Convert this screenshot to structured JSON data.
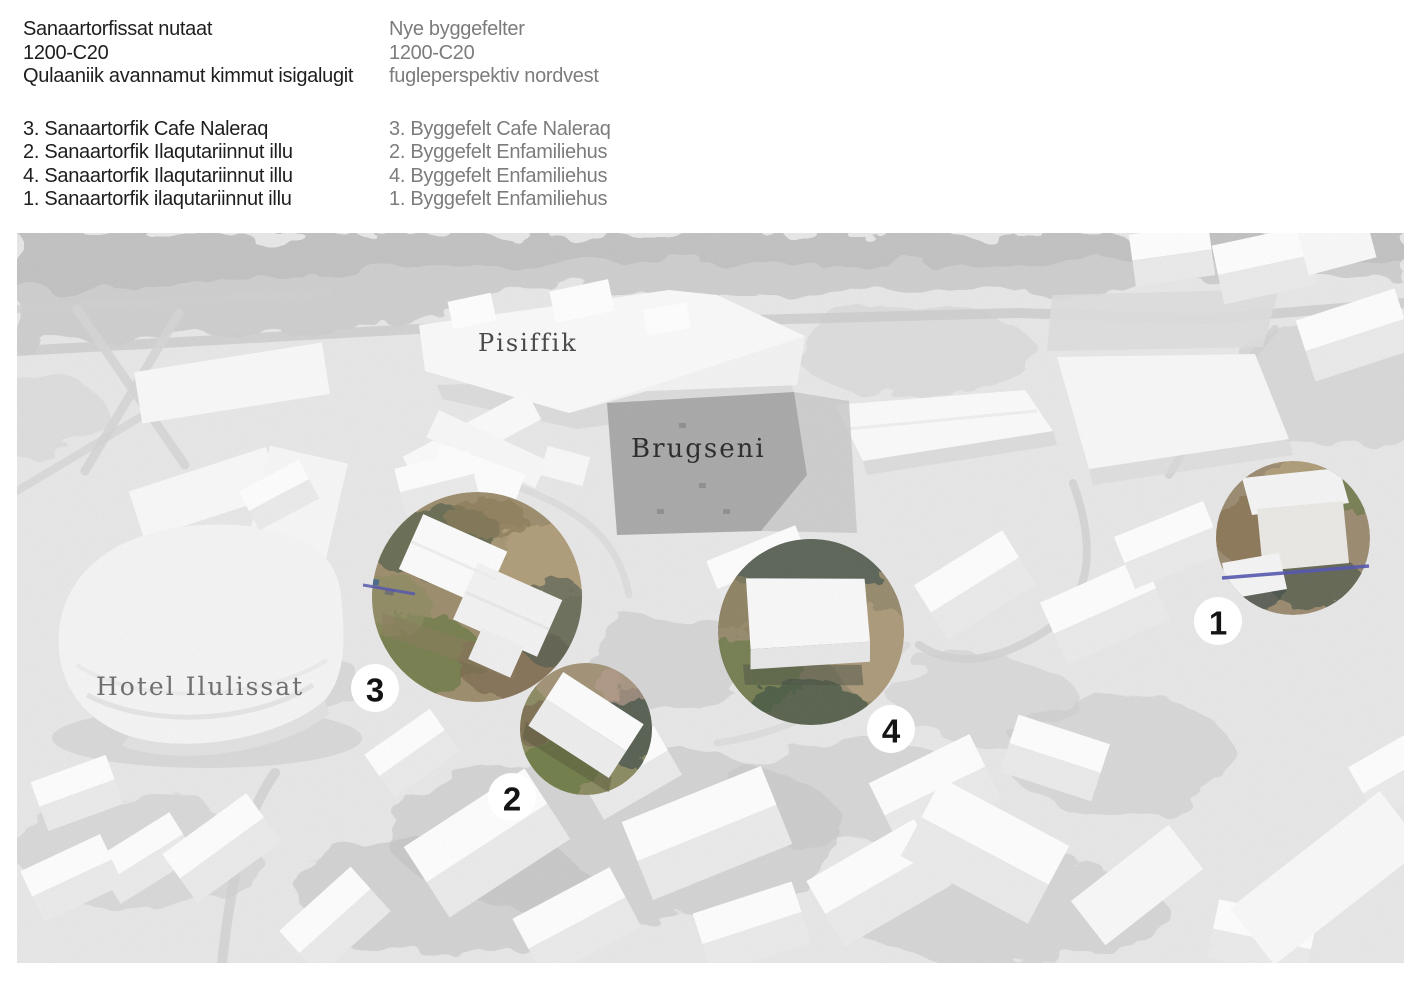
{
  "document": {
    "header_left": {
      "title": "Sanaartorfissat nutaat",
      "code": "1200-C20",
      "subtitle": "Qulaaniik avannamut kimmut isigalugit",
      "items": [
        "3. Sanaartorfik Cafe Naleraq",
        "2. Sanaartorfik Ilaqutariinnut illu",
        "4. Sanaartorfik Ilaqutariinnut illu",
        "1. Sanaartorfik ilaqutariinnut illu"
      ]
    },
    "header_right": {
      "title": "Nye byggefelter",
      "code": "1200-C20",
      "subtitle": "fugleperspektiv nordvest",
      "items": [
        "3. Byggefelt Cafe Naleraq",
        "2. Byggefelt Enfamiliehus",
        "4. Byggefelt Enfamiliehus",
        "1. Byggefelt Enfamiliehus"
      ]
    }
  },
  "map": {
    "place_labels": {
      "pisiffik": "Pisiffik",
      "brugseni": "Brugseni",
      "hotel_ilulissat": "Hotel Ilulissat"
    },
    "site_markers": [
      {
        "number": "3"
      },
      {
        "number": "2"
      },
      {
        "number": "4"
      },
      {
        "number": "1"
      }
    ],
    "colors": {
      "marker_bg": "#ffffff",
      "marker_text": "#141414",
      "pipe_blue": "#5456ae",
      "header_left_text": "#1e1e1e",
      "header_right_text": "#7c7c7c"
    }
  }
}
